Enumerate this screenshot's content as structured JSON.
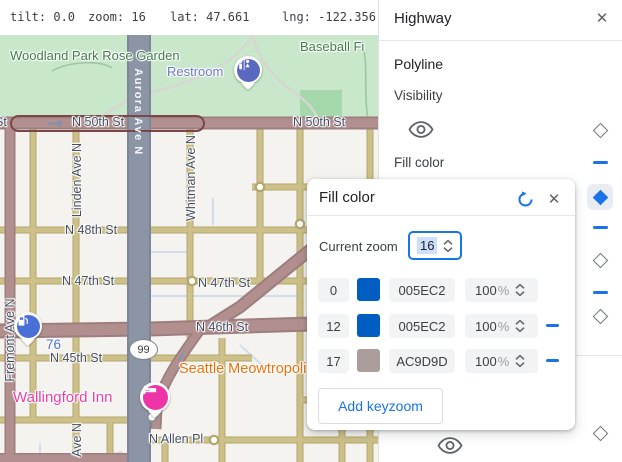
{
  "topbar": {
    "items": [
      "tilt: 0.0",
      "zoom: 16",
      "lat: 47.661",
      "lng: -122.356"
    ]
  },
  "panel": {
    "title": "Highway",
    "section": "Polyline",
    "visibility_label": "Visibility",
    "fill_color_label": "Fill color"
  },
  "dialog": {
    "title": "Fill color",
    "current_zoom_label": "Current zoom",
    "current_zoom": "16",
    "percent_sign": "%",
    "add_button": "Add keyzoom",
    "rows": [
      {
        "zoom": "0",
        "hex": "005EC2",
        "color": "#005EC2",
        "opacity": "100",
        "removable": false
      },
      {
        "zoom": "12",
        "hex": "005EC2",
        "color": "#005EC2",
        "opacity": "100",
        "removable": true
      },
      {
        "zoom": "17",
        "hex": "AC9D9D",
        "color": "#AC9D9D",
        "opacity": "100",
        "removable": true
      }
    ]
  },
  "icons": {
    "close": "✕"
  },
  "map": {
    "labels": {
      "woodland": "Woodland Park Rose Garden",
      "baseball": "Baseball Fi",
      "restroom": "Restroom",
      "n50_w": "N 50th St",
      "n50_e": "N 50th St",
      "st_partial": "St",
      "aurora": "Aurora Ave N",
      "linden": "Linden Ave N",
      "whitman": "Whitman Ave N",
      "n48": "N 48th St",
      "n47_w": "N 47th St",
      "n47_e": "N 47th St",
      "seventysix": "76",
      "n46": "N 46th St",
      "n45": "N 45th St",
      "meowtropolis": "Seattle Meowtropoli",
      "wallingford": "Wallingford Inn",
      "nallen": "N Allen Pl",
      "fremont": "Fremont Ave N",
      "ave_n": "Ave N",
      "shield": "99"
    },
    "colors": {
      "highway_fill": "#b28f8f",
      "highway_casing": "#9d7d7d",
      "arterial_fill": "#cdc189",
      "aurora_fill": "#8c95a6",
      "park": "#c9e7ca",
      "ballfield": "#a5d8ab",
      "background": "#f4f3f0",
      "selection_outline": "#7a4646",
      "minor_line": "#d3dce9",
      "accent_blue": "#1a73e8"
    }
  }
}
